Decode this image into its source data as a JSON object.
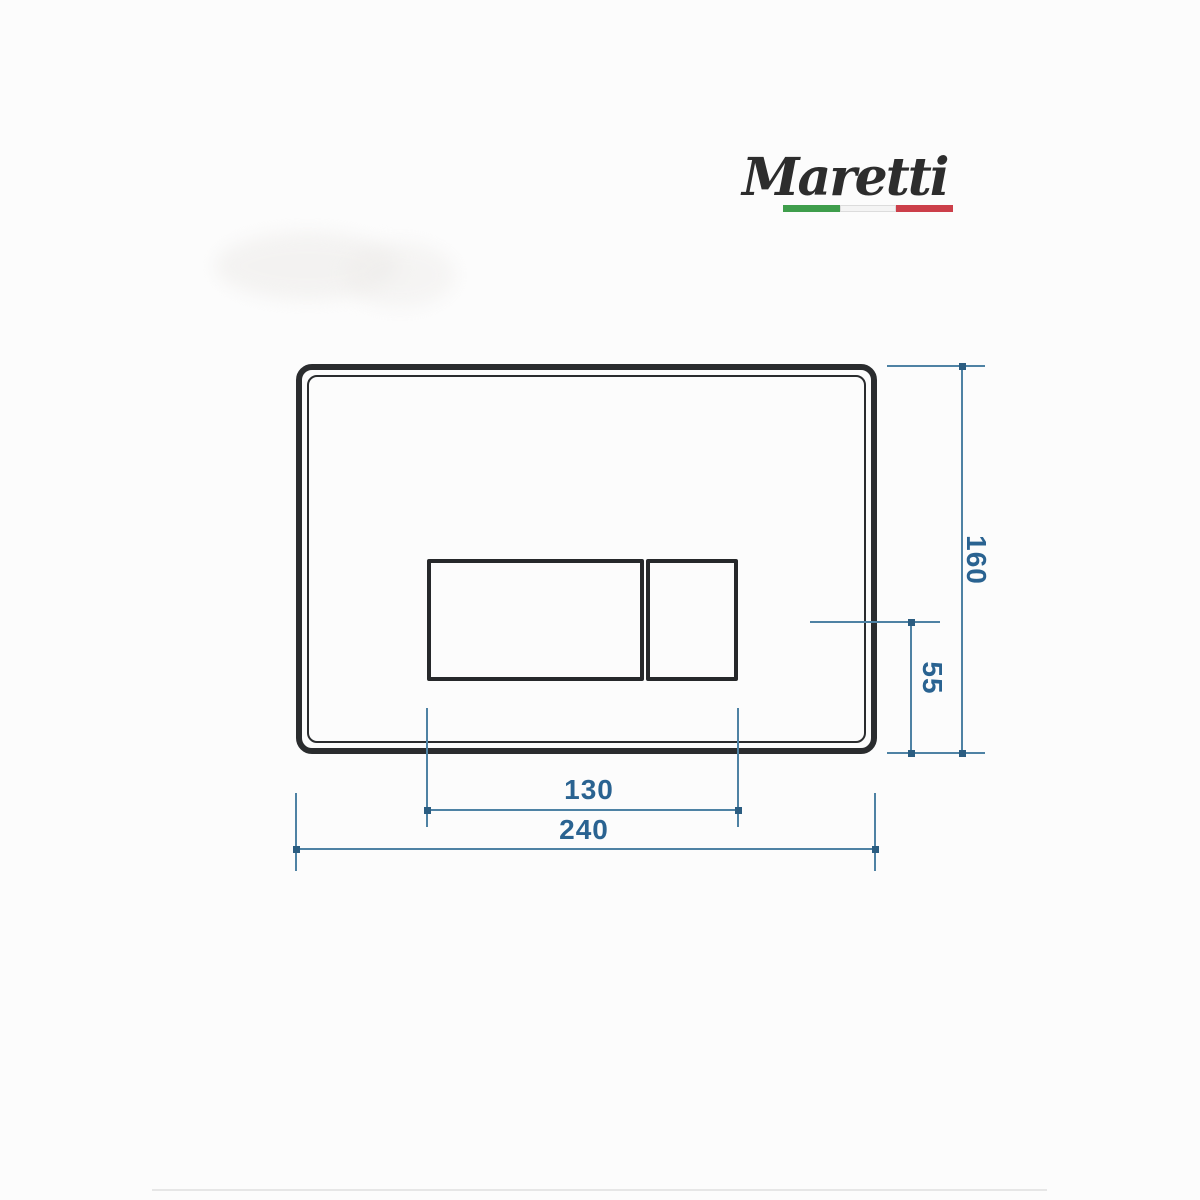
{
  "logo": {
    "text": "Maretti"
  },
  "dimensions": {
    "plate_height_mm": "160",
    "button_offset_mm": "55",
    "button_width_mm": "130",
    "plate_width_mm": "240"
  },
  "colors": {
    "dimension_line": "#4e82a4",
    "dimension_dot": "#2b5d81",
    "dimension_text": "#2a6391",
    "outline_black": "#2a2c2e",
    "flag_green": "#3f9e4c",
    "flag_white": "#f4f4f4",
    "flag_red": "#cc3f4a",
    "background": "#fcfcfc"
  }
}
